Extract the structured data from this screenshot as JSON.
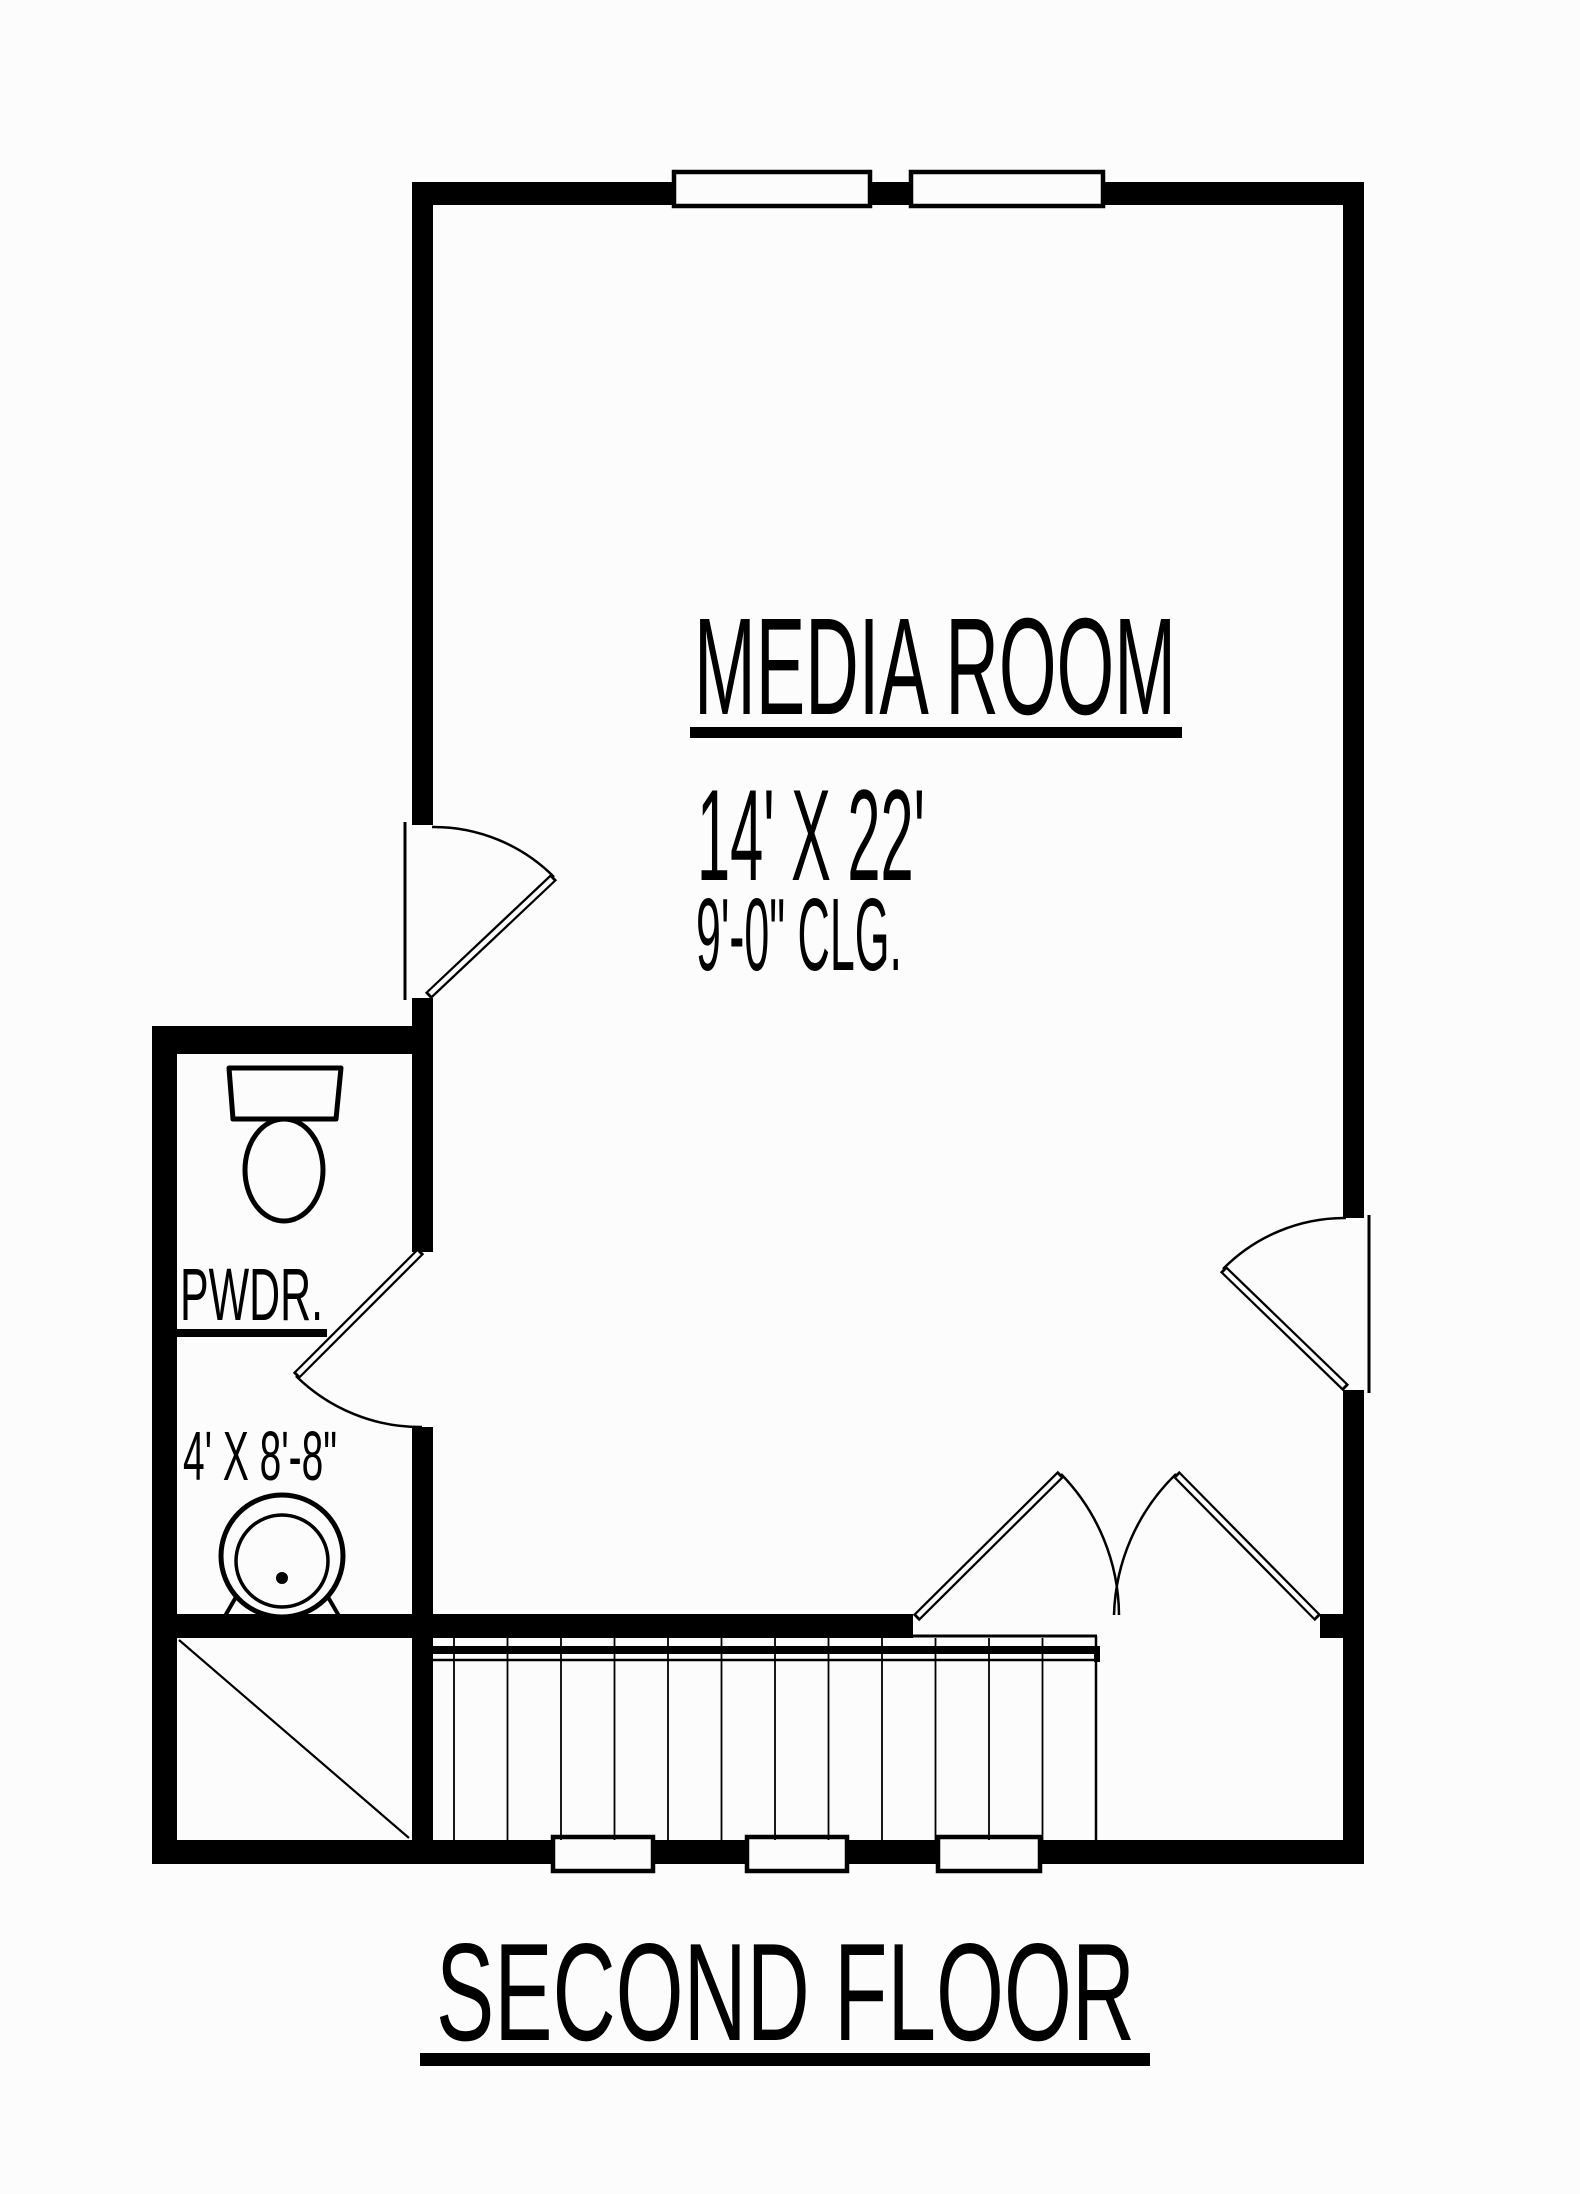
{
  "drawing": {
    "title": "SECOND FLOOR",
    "rooms": {
      "media_room": {
        "name": "MEDIA ROOM",
        "size": "14' X 22'",
        "ceiling": "9'-0\" CLG."
      },
      "powder_room": {
        "name": "PWDR.",
        "size": "4' X 8'-8\""
      }
    },
    "colors": {
      "line": "#000000",
      "paper": "#fcfcfc"
    }
  }
}
